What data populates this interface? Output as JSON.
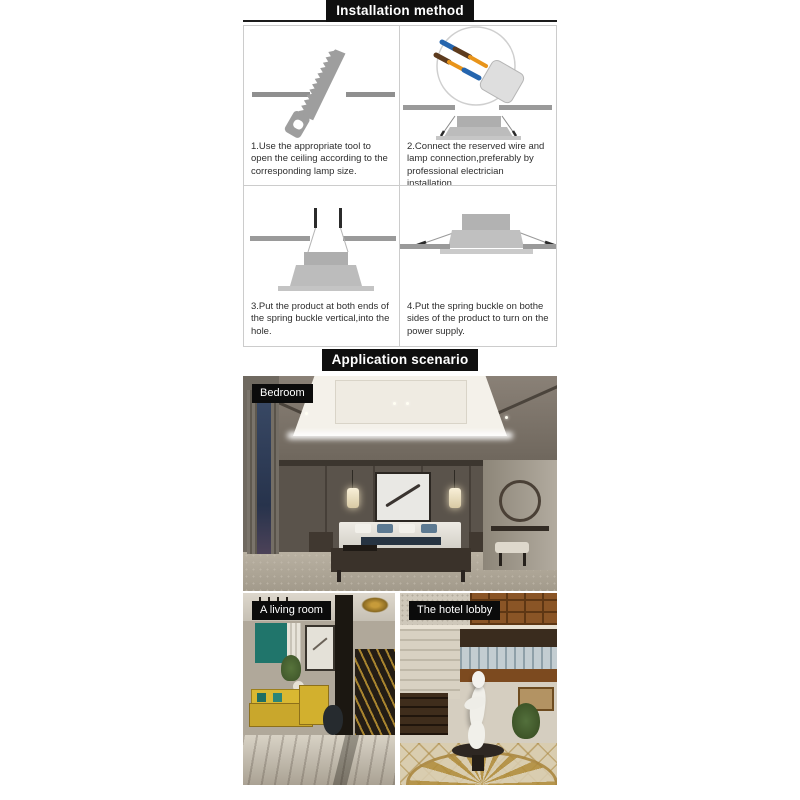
{
  "header": {
    "installation_title": "Installation method",
    "application_title": "Application scenario"
  },
  "installation": {
    "steps": [
      {
        "icon": "saw-cut-ceiling",
        "caption": "1.Use the appropriate tool to open the ceiling according to the corresponding lamp size."
      },
      {
        "icon": "wire-connector-lamp",
        "caption": "2.Connect the reserved wire and lamp connection,preferably by professional electrician installation."
      },
      {
        "icon": "spring-buckle-vertical",
        "caption": "3.Put the product at both ends of the spring buckle vertical,into the hole."
      },
      {
        "icon": "spring-buckle-installed",
        "caption": "4.Put the spring buckle on bothe sides of the product to turn on the power supply."
      }
    ]
  },
  "application": {
    "scenes": [
      {
        "label": "Bedroom"
      },
      {
        "label": "A living room"
      },
      {
        "label": "The hotel lobby"
      }
    ]
  },
  "colors": {
    "header_bg": "#0f0f0f",
    "header_text": "#ffffff",
    "illustration_gray": "#9a9a9a",
    "lamp_gray": "#bcbcbc",
    "wire_blue": "#2565ae",
    "wire_brown": "#5d3b1e",
    "wire_copper": "#e8941a"
  }
}
